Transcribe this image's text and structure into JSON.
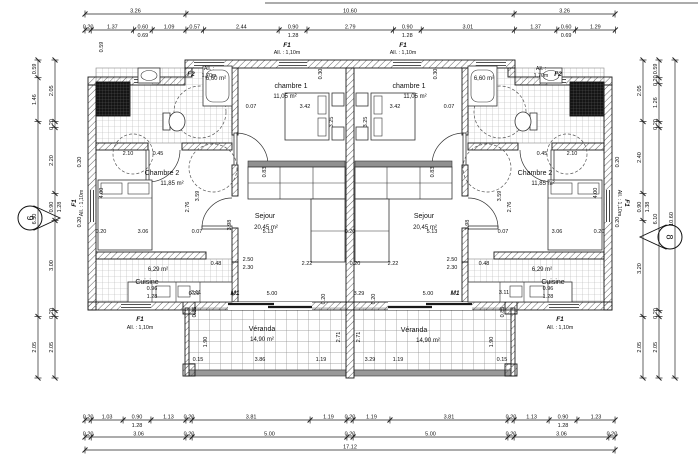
{
  "rooms": {
    "chambre1": {
      "label": "chambre 1",
      "area": "11,05 m²"
    },
    "chambre2": {
      "label": "Chambre 2",
      "area": "11,85 m²"
    },
    "sejour": {
      "label": "Sejour",
      "area": "20,45 m²"
    },
    "cuisine": {
      "label": "Cuisine",
      "area": "6,29 m²"
    },
    "veranda": {
      "label": "Véranda",
      "area": "14,90 m²"
    },
    "sdb": {
      "area": "6,60 m²"
    }
  },
  "openings": {
    "f1": {
      "code": "F1",
      "allege": "All. : 1,10m"
    },
    "f2": {
      "code": "F2",
      "allege_l1": "All. :",
      "allege_l2": "1,70m"
    },
    "m1": {
      "code": "M1"
    }
  },
  "markers": {
    "left": "6",
    "right": "8"
  },
  "dim_chains": [
    {
      "name": "top-outer",
      "dir": "h",
      "x": 85,
      "y": 14,
      "ppm": 30.96,
      "values": [
        "3.26",
        "10.60",
        "3.26"
      ]
    },
    {
      "name": "top-detail",
      "dir": "h",
      "x": 85,
      "y": 30,
      "ppm": 30.96,
      "values": [
        "0.20",
        "1.37",
        "0.60",
        "1.09",
        "0.57",
        "2.44",
        "0.90",
        "2.79",
        "0.90",
        "3.01",
        "1.37",
        "0.60",
        "1.29"
      ],
      "subs": {
        "2": "0.69",
        "6": "1.28",
        "8": "1.28",
        "11": "0.69"
      }
    },
    {
      "name": "bottom-detail",
      "dir": "h",
      "x": 85,
      "y": 420,
      "ppm": 30.96,
      "values": [
        "0.20",
        "1.03",
        "0.90",
        "1.13",
        "0.20",
        "3.81",
        "1.19",
        "0.20",
        "1.19",
        "3.81",
        "0.20",
        "1.13",
        "0.90",
        "1.23"
      ],
      "subs": {
        "2": "1.28",
        "12": "1.28"
      }
    },
    {
      "name": "bottom-mid",
      "dir": "h",
      "x": 85,
      "y": 437,
      "ppm": 30.96,
      "values": [
        "0.20",
        "3.06",
        "0.20",
        "5.00",
        "0.20",
        "5.00",
        "0.20",
        "3.06",
        "0.20"
      ]
    },
    {
      "name": "bottom-total",
      "dir": "h",
      "x": 85,
      "y": 450,
      "ppm": 30.96,
      "values": [
        "17.12"
      ]
    },
    {
      "name": "left-outer",
      "dir": "v",
      "x": 38,
      "y": 60,
      "ppm": 30,
      "values": [
        "0.59",
        "1.46",
        "6.50",
        "2.05"
      ]
    },
    {
      "name": "left-inner",
      "dir": "v",
      "x": 55,
      "y": 60,
      "ppm": 30,
      "values": [
        "2.05",
        "0.20",
        "2.20",
        "0.90",
        "3.00",
        "0.20",
        "2.05"
      ],
      "subs": {
        "3": "1.28"
      }
    },
    {
      "name": "right-inner",
      "dir": "v",
      "x": 643,
      "y": 60,
      "ppm": 30,
      "values": [
        "2.05",
        "2.40",
        "0.90",
        "3.20",
        "2.05"
      ],
      "subs": {
        "2": "1.38"
      }
    },
    {
      "name": "right-mid",
      "dir": "v",
      "x": 659,
      "y": 60,
      "ppm": 30,
      "values": [
        "0.59",
        "0.20",
        "1.26",
        "0.20",
        "6.10",
        "0.20",
        "2.05"
      ]
    },
    {
      "name": "right-outer",
      "dir": "v",
      "x": 675,
      "y": 60,
      "ppm": 30,
      "values": [
        "10.60"
      ]
    }
  ],
  "inline": [
    "3.42",
    "0.07",
    "3.42",
    "0.07",
    "3.25",
    "3.25",
    "5.13",
    "0.20",
    "5.13",
    "2.22",
    "2.22",
    "2.50",
    "2.30",
    "2.50",
    "2.30",
    "0.48",
    "0.48",
    "2.10",
    "0.45",
    "0.45",
    "2.10",
    "0.20",
    "3.06",
    "0.07",
    "0.07",
    "3.06",
    "0.20",
    "4.00",
    "4.00",
    "2.76",
    "2.76",
    "3.59",
    "3.59",
    "3.98",
    "3.98",
    "0.83",
    "0.83",
    "0.96",
    "1.28",
    "0.96",
    "1.28",
    "3.11",
    "3.11",
    "5.00",
    "5.00",
    "0.29",
    "3.29",
    "3.86",
    "1.19",
    "3.29",
    "1.19",
    "0.15",
    "0.15",
    "2.71",
    "2.71",
    "1.90",
    "1.90",
    "0.85",
    "0.85",
    "0.20",
    "0.20",
    "0.59",
    "0.20",
    "0.20",
    "0.20",
    "0.20",
    "0.30",
    "0.30",
    "0.20"
  ]
}
